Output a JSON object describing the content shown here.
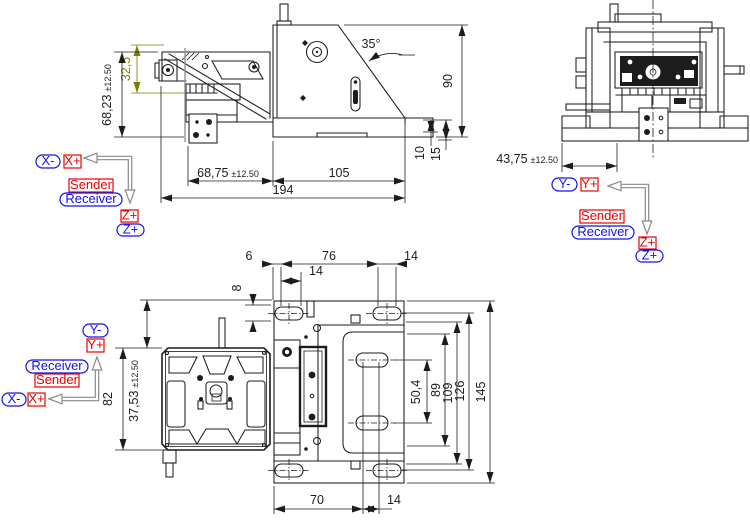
{
  "colors": {
    "drawing": "#1c1c1c",
    "highlight_dim": "#7e7e00",
    "axis_red": "#e80000",
    "axis_blue": "#1212ee",
    "arrow_gray": "#8a8a8a",
    "background": "#ffffff"
  },
  "side_view": {
    "dims": {
      "beam_height": "32,5",
      "total_height": "68,23",
      "total_height_tol": "±12.50",
      "left_width": "68,75",
      "left_width_tol": "±12.50",
      "right_width": "105",
      "total_width": "194",
      "body_height": "90",
      "step_min": "10",
      "step_max": "15",
      "front_angle": "35°"
    }
  },
  "rear_view": {
    "dims": {
      "center_offset": "43,75",
      "center_offset_tol": "±12.50"
    }
  },
  "top_view": {
    "dims": {
      "slot_edge": "6",
      "slot_pitch": "76",
      "slot_len_right": "14",
      "slot_len_left": "14",
      "slot_height": "8",
      "hole_pitch": "50,4",
      "pocket_height": "89",
      "recess_height": "109",
      "slot_row_pitch": "126",
      "total_height": "145",
      "plate_height": "82",
      "plate_offset": "37,53",
      "plate_offset_tol": "±12.50",
      "bottom_width": "70",
      "bottom_slot": "14"
    }
  },
  "legend_side_view": {
    "x_minus": "X-",
    "x_plus": "X+",
    "sender": "Sender",
    "receiver": "Receiver",
    "z_plus_red": "Z+",
    "z_plus_blue": "Z+"
  },
  "legend_rear_view": {
    "y_minus": "Y-",
    "y_plus": "Y+",
    "sender": "Sender",
    "receiver": "Receiver",
    "z_plus_red": "Z+",
    "z_plus_blue": "Z+"
  },
  "legend_top_view": {
    "y_minus": "Y-",
    "y_plus": "Y+",
    "receiver": "Receiver",
    "sender": "Sender",
    "x_minus": "X-",
    "x_plus": "X+"
  }
}
